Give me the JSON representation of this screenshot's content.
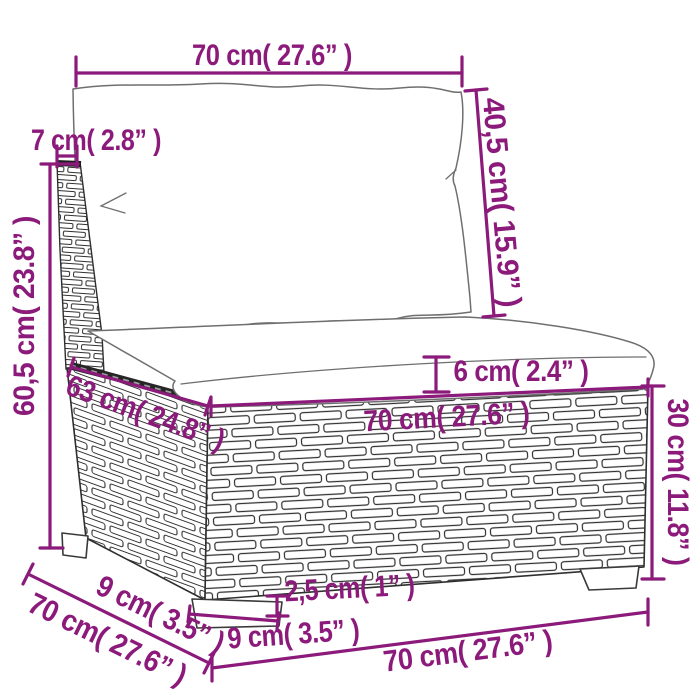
{
  "figure": {
    "kind": "product dimension diagram",
    "subject": "poly rattan modular sofa middle section with back cushion and seat cushion"
  },
  "dimensions": {
    "top_width": "70 cm( 27.6” )",
    "backrest_thickness": "7 cm( 2.8” )",
    "backrest_height": "40,5 cm( 15.9” )",
    "overall_height": "60,5 cm( 23.8” )",
    "seat_side_depth": "63 cm( 24.8” )",
    "seat_front_width": "70 cm( 27.6” )",
    "seat_cushion_thickness": "6 cm( 2.4” )",
    "base_height": "30 cm( 11.8” )",
    "foot_height": "2,5 cm( 1” )",
    "foot_width": "9 cm( 3.5” )",
    "side_foot_depth": "9 cm( 3.5” )",
    "overall_depth": "70 cm( 27.6” )",
    "bottom_width": "70 cm( 27.6” )"
  },
  "colors": {
    "dimension_accent": "#8B1A7B",
    "line_art": "#3c3c3c",
    "background": "#ffffff"
  }
}
